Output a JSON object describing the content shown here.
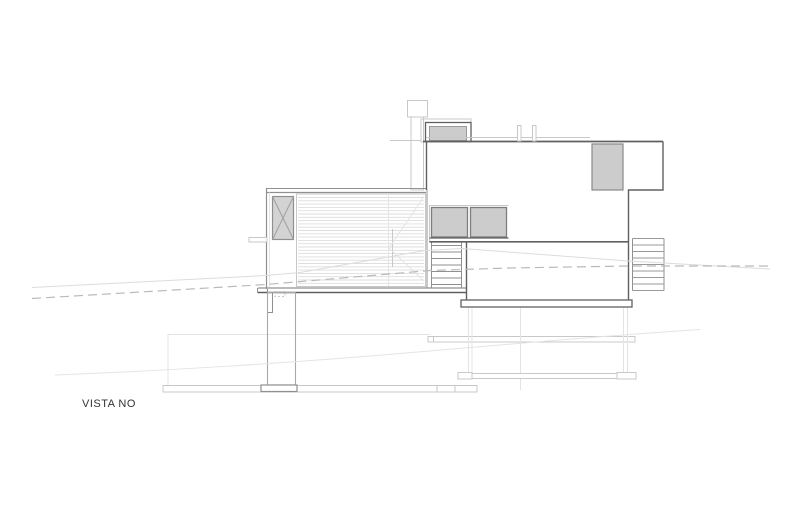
{
  "page": {
    "width": 800,
    "height": 530,
    "background": "#ffffff"
  },
  "drawing": {
    "view_label": "VISTA NO",
    "colors": {
      "page_bg": "#ffffff",
      "outline_dark": "#606060",
      "outline_medium": "#909090",
      "outline_light": "#c8c8c8",
      "outline_faint": "#e4e4e4",
      "glass_fill": "#cccccc",
      "panel_fill": "#d3d3d3",
      "terrain_dash": "#bababa",
      "label_text": "#333333"
    }
  }
}
